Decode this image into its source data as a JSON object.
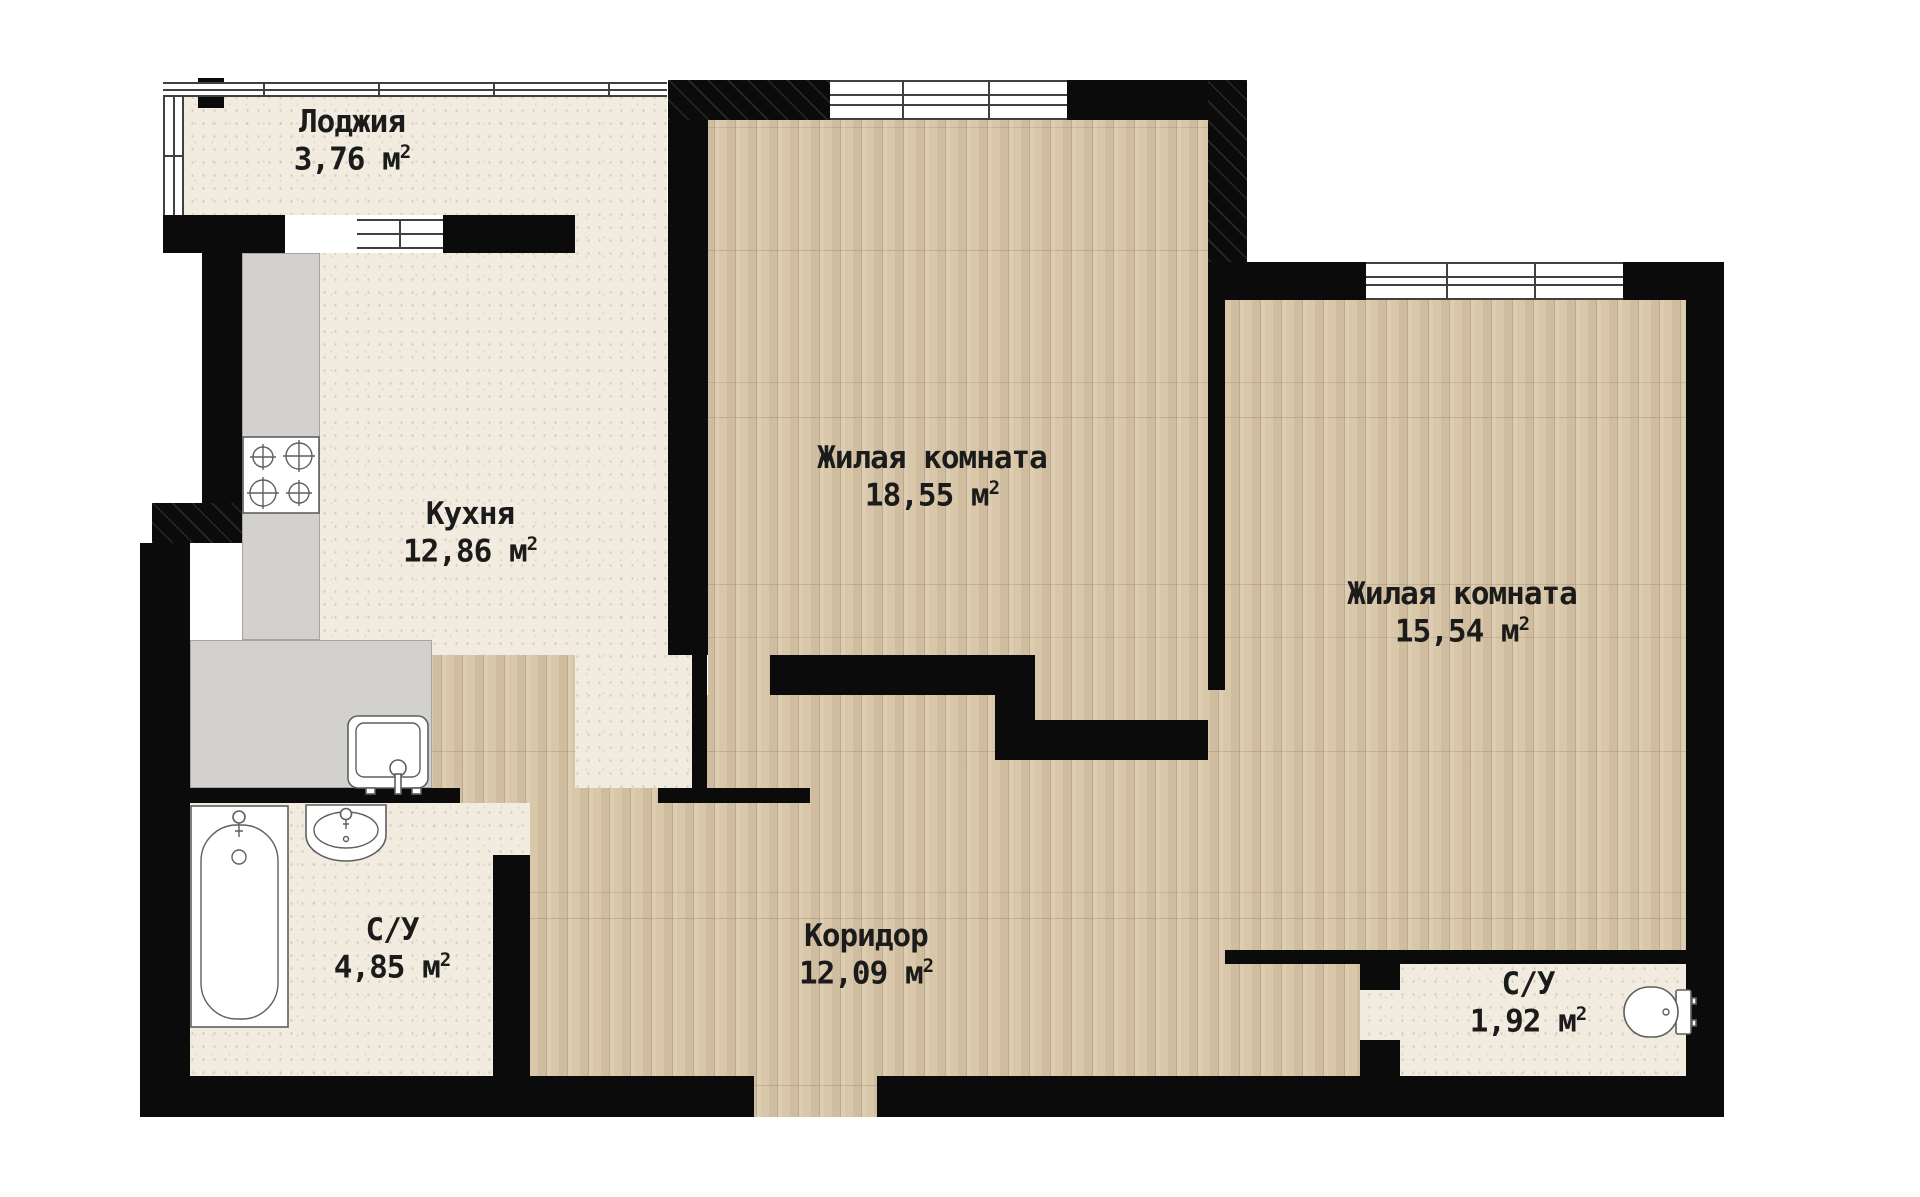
{
  "plan_type": "apartment-floor-plan",
  "colors": {
    "wall": "#0b0b0b",
    "wood_floor": "#d9c7a9",
    "tile_floor": "#f1ecdf",
    "counter": "#d2d1cd",
    "window_frame": "#404040",
    "label_text": "#1b1b1b",
    "background": "#ffffff"
  },
  "rooms": [
    {
      "id": "loggia",
      "name": "Лоджия",
      "area": "3,76",
      "unit": "м",
      "sup": "2"
    },
    {
      "id": "kitchen",
      "name": "Кухня",
      "area": "12,86",
      "unit": "м",
      "sup": "2"
    },
    {
      "id": "living-room-1",
      "name": "Жилая комната",
      "area": "18,55",
      "unit": "м",
      "sup": "2"
    },
    {
      "id": "living-room-2",
      "name": "Жилая комната",
      "area": "15,54",
      "unit": "м",
      "sup": "2"
    },
    {
      "id": "corridor",
      "name": "Коридор",
      "area": "12,09",
      "unit": "м",
      "sup": "2"
    },
    {
      "id": "bathroom-1",
      "name": "С/У",
      "area": "4,85",
      "unit": "м",
      "sup": "2"
    },
    {
      "id": "bathroom-2",
      "name": "С/У",
      "area": "1,92",
      "unit": "м",
      "sup": "2"
    }
  ]
}
